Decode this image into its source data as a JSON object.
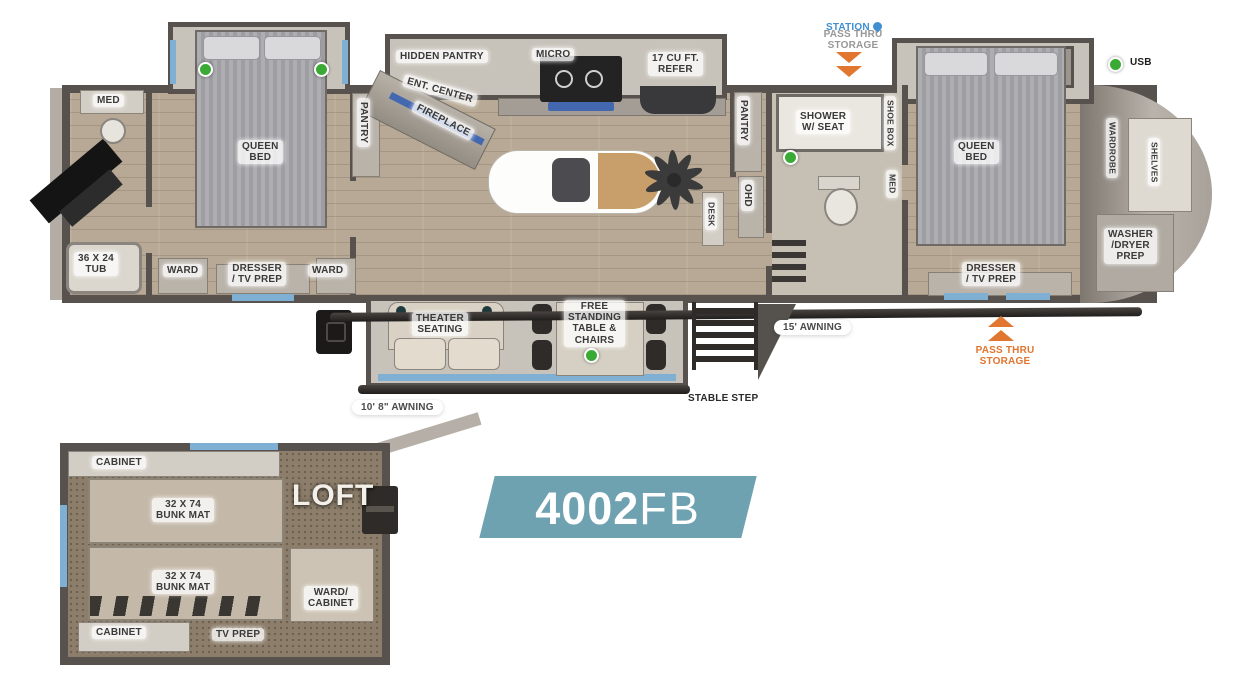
{
  "badge": {
    "number": "4002",
    "trim": "FB"
  },
  "rear_bath": {
    "med": "MED",
    "tub": "36 X 24\nTUB"
  },
  "rear_bed": {
    "queen": "QUEEN\nBED",
    "ward_l": "WARD",
    "dresser": "DRESSER\n/ TV PREP",
    "ward_r": "WARD"
  },
  "kitchen": {
    "pantry_rear": "PANTRY",
    "hidden_pantry": "HIDDEN PANTRY",
    "ent_center": "ENT. CENTER",
    "fireplace": "FIREPLACE",
    "micro": "MICRO",
    "refer": "17 CU FT.\nREFER",
    "pantry_mid": "PANTRY",
    "ohd": "OHD",
    "desk": "DESK"
  },
  "bath": {
    "shower": "SHOWER\nW/ SEAT",
    "shoe_box": "SHOE BOX",
    "med": "MED"
  },
  "front_bed": {
    "queen": "QUEEN\nBED",
    "wardrobe": "WARDROBE",
    "shelves": "SHELVES",
    "washer": "WASHER\n/DRYER\nPREP",
    "dresser": "DRESSER\n/ TV PREP"
  },
  "living": {
    "theater": "THEATER\nSEATING",
    "table": "FREE\nSTANDING\nTABLE &\nCHAIRS"
  },
  "exterior": {
    "station": "STATION",
    "pass_thru_top": "PASS THRU\nSTORAGE",
    "pass_thru_right": "PASS THRU\nSTORAGE",
    "usb": "USB",
    "awning_rear": "10' 8\" AWNING",
    "awning_main": "15' AWNING",
    "stable_step": "STABLE STEP"
  },
  "loft": {
    "cabinet_top": "CABINET",
    "bunk_top": "32 X 74\nBUNK MAT",
    "bunk_bottom": "32 X 74\nBUNK MAT",
    "loft": "LOFT",
    "ward_cabinet": "WARD/\nCABINET",
    "cabinet_bottom": "CABINET",
    "tv_prep": "TV PREP"
  },
  "colors": {
    "badge": "#6FA2B1",
    "orange": "#E0762F",
    "station_blue": "#3F8FD2",
    "green": "#3BAA35",
    "window_blue": "#7FB0D4",
    "wall": "#57524D"
  }
}
